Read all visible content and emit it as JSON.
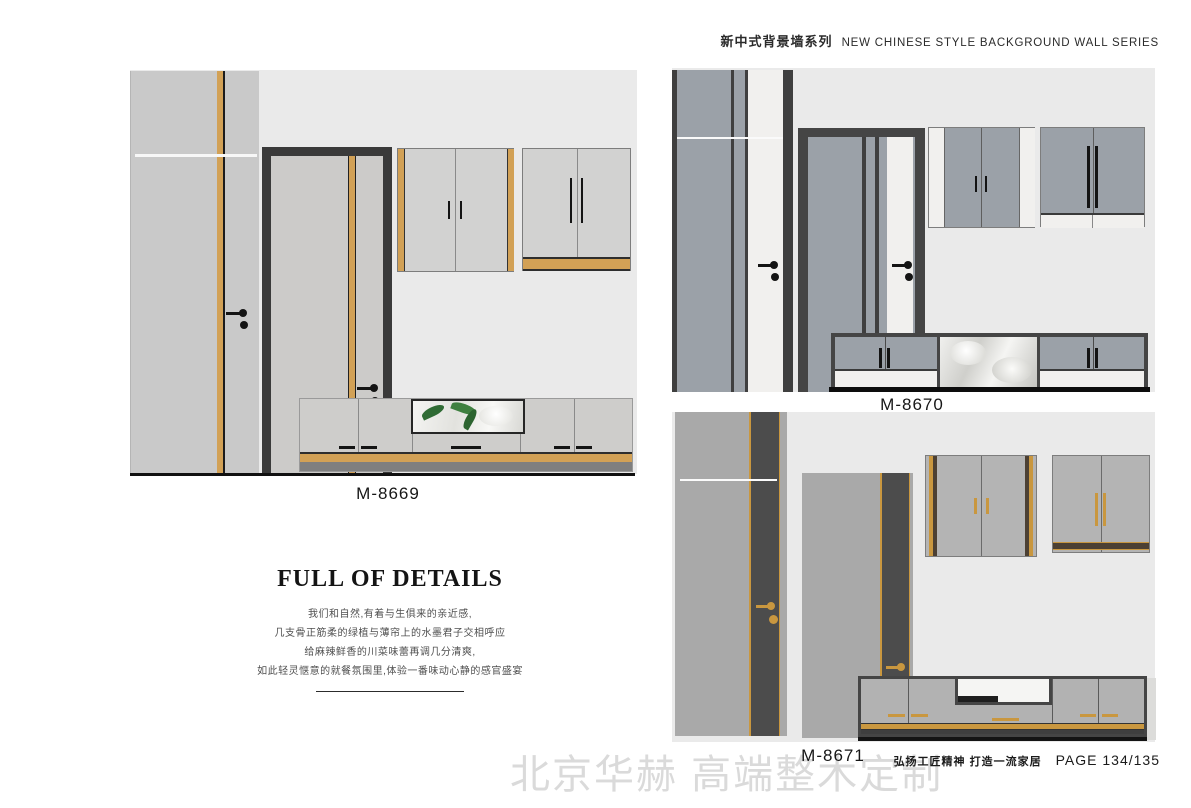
{
  "header": {
    "series_cn": "新中式背景墙系列",
    "series_en": "NEW CHINESE STYLE BACKGROUND WALL SERIES"
  },
  "designs": [
    {
      "label": "M-8669"
    },
    {
      "label": "M-8670"
    },
    {
      "label": "M-8671"
    }
  ],
  "details": {
    "heading": "FULL OF DETAILS",
    "lines": [
      "我们和自然,有着与生俱来的亲近感,",
      "几支骨正筋柔的绿植与薄帘上的水墨君子交相呼应",
      "给麻辣鲜香的川菜味蕾再调几分清爽,",
      "如此轻灵惬意的就餐氛围里,体验一番味动心静的感官盛宴"
    ]
  },
  "footer": {
    "watermark": "北京华赫 高端整木定制",
    "slogan": "弘扬工匠精神  打造一流家居",
    "page_label": "PAGE 134/135"
  },
  "colors": {
    "gold": "#d2a156",
    "gold_dark": "#c9973f",
    "frame_dark": "#3f3f3f",
    "panel_light": "#c9c9c9",
    "panel_mid_gray": "#9ba1a8",
    "panel_warm_gray": "#a9a9a9",
    "wall": "#eaeaea"
  }
}
